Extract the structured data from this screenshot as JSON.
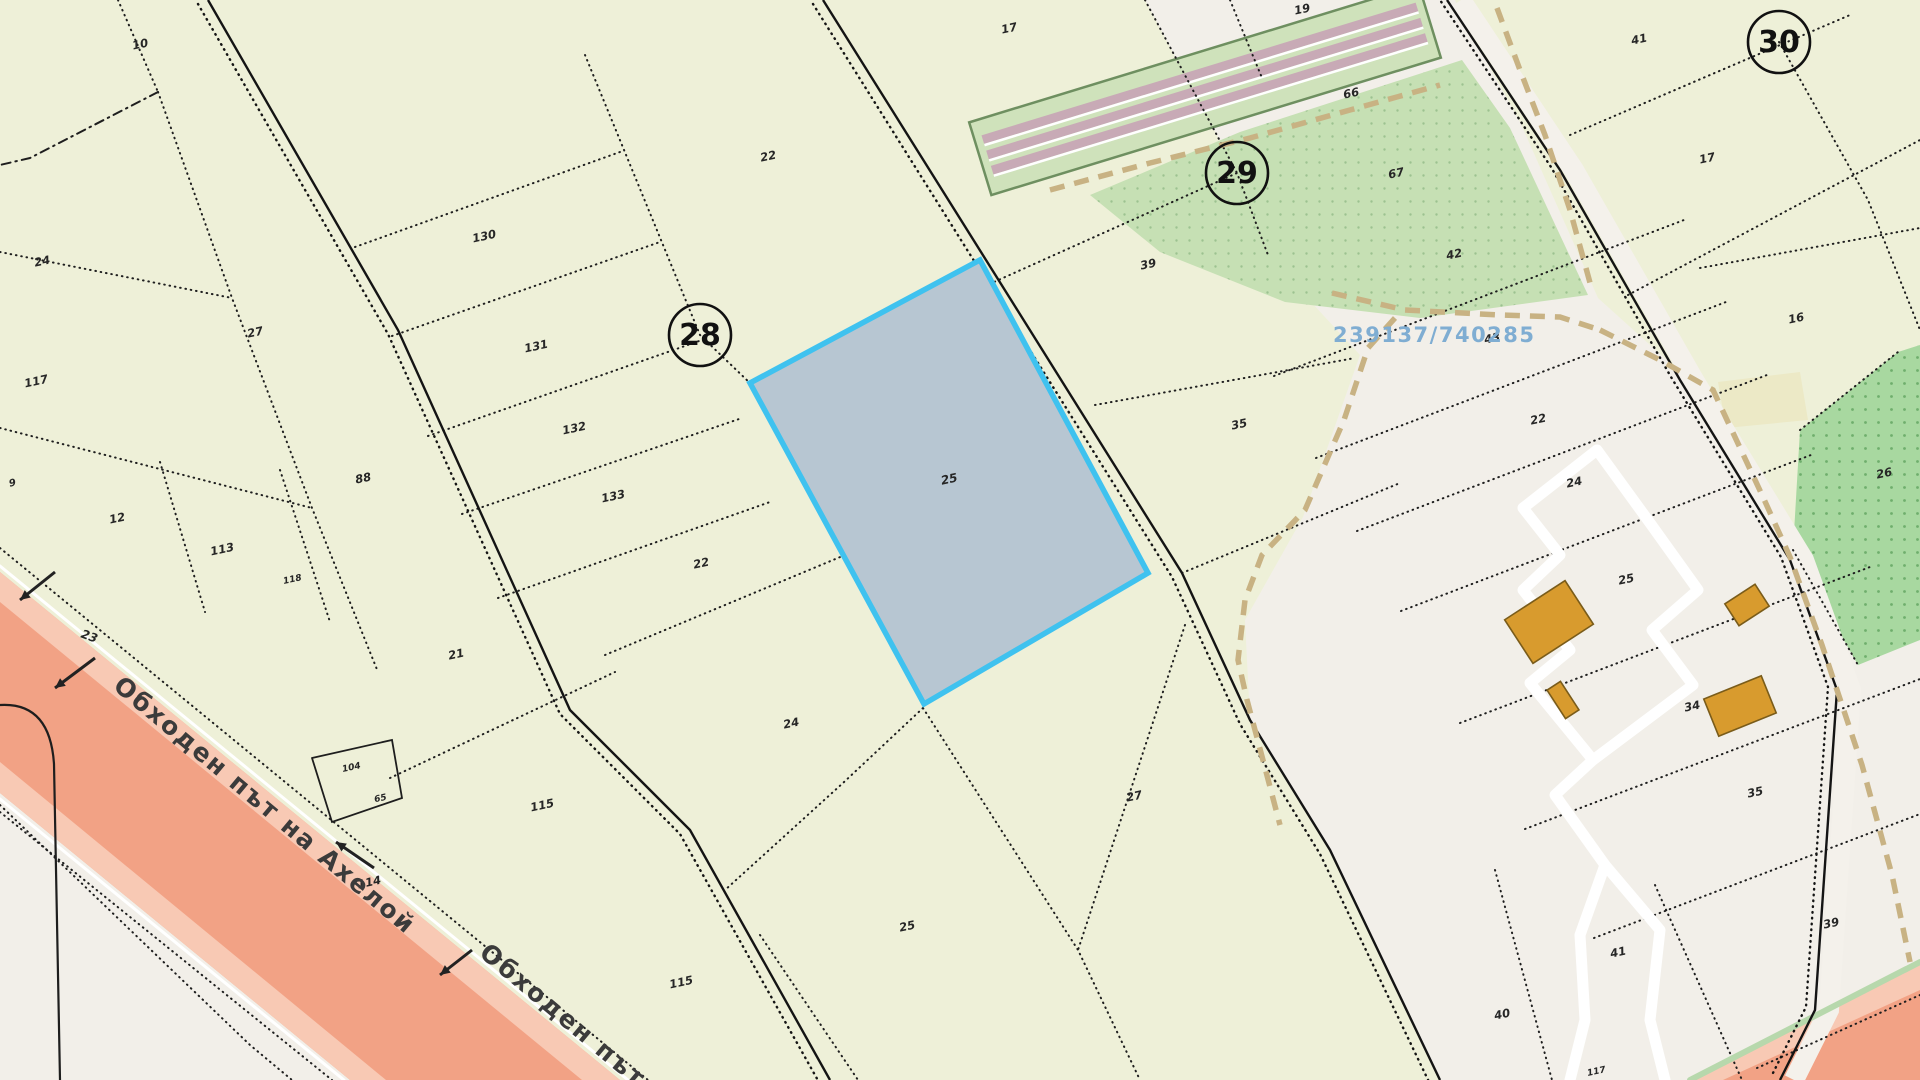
{
  "meta": {
    "type": "cadastral-map",
    "selected_parcel_label": "25",
    "reference_number": "239137/740285",
    "road_name": "Обходен път на Ахелой",
    "road_name_short": "Обходен път на",
    "block_numbers": [
      "28",
      "29",
      "30"
    ]
  },
  "colors": {
    "base": "#eef0d8",
    "urban_white": "#f2efe9",
    "road_salmon": "#f2a285",
    "road_salmon_edge": "#f8c9b4",
    "selected_fill": "#b7c6d2",
    "selected_border": "#3fc2ef",
    "boundary_dark": "#1e1e1e",
    "dash_tan": "#c8b283",
    "building_fill": "#d89b2e",
    "building_stroke": "#7a5c1a",
    "green_bright": "#a8d8a0",
    "green_light": "#c6e0b4",
    "rail_band": "#cfe2bb",
    "rail_stripe": "#c8aab6",
    "rail_edge": "#6e8f60",
    "ref_blue": "#7fadd2",
    "road_label_gray": "#3b3b3b"
  },
  "map": {
    "width": 1920,
    "height": 1080,
    "patterns": [
      {
        "id": "dotsA",
        "size": 13,
        "bg": "#a8d8a0",
        "dot": "#6fae6c",
        "r": 1.4
      },
      {
        "id": "dotsB",
        "size": 13,
        "bg": "#c6e0b4",
        "dot": "#9cc290",
        "r": 1.2
      }
    ],
    "polygons": [
      {
        "name": "urban-white-region",
        "pts": "1145,0 1237,173 1300,290 1360,355 1303,517 1245,620 1250,720 1330,850 1440,1080 1920,1080 1920,0",
        "fill": "#f2efe9"
      },
      {
        "name": "white-corner-bottom-left",
        "pts": "0,793 350,1080 0,1080",
        "fill": "#f2efe9"
      },
      {
        "name": "yellow-region-top-right",
        "pts": "1455,0 1920,0 1920,430 1858,452 1790,545 1700,390 1598,298 1520,122 1468,28",
        "fill": "#eef0d8"
      },
      {
        "name": "yellow-patch-small",
        "pts": "1718,382 1800,372 1808,420 1726,428",
        "fill": "#ece9c6"
      },
      {
        "name": "green-parcel-26",
        "pts": "1800,430 1898,352 1920,345 1920,640 1858,665 1793,550",
        "pattern": "dotsA"
      },
      {
        "name": "green-parcel-67",
        "pts": "1090,195 1240,132 1462,60 1510,128 1588,295 1420,318 1285,302 1160,252",
        "pattern": "dotsB"
      },
      {
        "name": "salmon-road-band-core",
        "pts": "0,572 620,1080 350,1080 0,793",
        "fill": "#f2a285"
      },
      {
        "name": "salmon-road-edge-upper",
        "pts": "0,572 620,1080 582,1080 0,602",
        "fill": "#f8c9b4"
      },
      {
        "name": "salmon-road-edge-lower",
        "pts": "0,762 386,1080 350,1080 0,793",
        "fill": "#f8c9b4"
      },
      {
        "name": "salmon-patch-bottom-right",
        "pts": "1690,1080 1920,962 1920,1080",
        "fill": "#f2a285"
      },
      {
        "name": "salmon-patch-edge",
        "pts": "1690,1080 1920,962 1920,990 1723,1080",
        "fill": "#f8c9b4"
      }
    ],
    "railway": {
      "cx": 1205,
      "cy": 90,
      "len": 470,
      "w": 76,
      "rot": -17,
      "stripes": [
        -22,
        -6,
        10
      ],
      "stripe_h": 9
    },
    "white_band_roadB": {
      "pts": "1447,0 1560,170 1680,380 1790,560 1837,690 1815,1010 1780,1080",
      "dx": 14,
      "dy": 0,
      "w": 20
    },
    "lines": [
      {
        "name": "boundary",
        "pts": "118,0 158,92"
      },
      {
        "name": "boundary",
        "pts": "158,92 30,158 0,165",
        "dash": "9 5 1.5 5"
      },
      {
        "name": "boundary",
        "pts": "158,92 232,298 312,508 378,672"
      },
      {
        "name": "boundary",
        "pts": "0,252 232,298"
      },
      {
        "name": "boundary",
        "pts": "0,428 312,508"
      },
      {
        "name": "boundary",
        "pts": "160,462 205,612"
      },
      {
        "name": "boundary",
        "pts": "280,470 330,622"
      },
      {
        "name": "boundary",
        "pts": "355,247 620,152"
      },
      {
        "name": "boundary",
        "pts": "392,336 660,242"
      },
      {
        "name": "boundary",
        "pts": "428,436 702,340"
      },
      {
        "name": "boundary",
        "pts": "462,514 742,418"
      },
      {
        "name": "boundary",
        "pts": "498,598 770,502"
      },
      {
        "name": "boundary",
        "pts": "585,55 700,335 752,385"
      },
      {
        "name": "boundary",
        "pts": "390,778 615,672"
      },
      {
        "name": "boundary",
        "pts": "605,655 845,555"
      },
      {
        "name": "boundary",
        "pts": "923,708 843,783 725,890"
      },
      {
        "name": "boundary",
        "pts": "923,708 1078,950 1140,1080"
      },
      {
        "name": "boundary",
        "pts": "1185,625 1078,950"
      },
      {
        "name": "boundary",
        "pts": "760,935 858,1080"
      },
      {
        "name": "boundary",
        "pts": "1145,0 1237,173"
      },
      {
        "name": "boundary",
        "pts": "965,295 1237,173 1268,255"
      },
      {
        "name": "boundary",
        "pts": "1095,405 1355,358"
      },
      {
        "name": "boundary",
        "pts": "1182,573 1400,483"
      },
      {
        "name": "boundary",
        "pts": "1274,376 1684,220"
      },
      {
        "name": "boundary",
        "pts": "1316,458 1726,302"
      },
      {
        "name": "boundary",
        "pts": "1357,531 1767,375"
      },
      {
        "name": "boundary",
        "pts": "1401,611 1811,455"
      },
      {
        "name": "boundary",
        "pts": "1460,723 1870,567"
      },
      {
        "name": "boundary",
        "pts": "1525,829 1920,679"
      },
      {
        "name": "boundary",
        "pts": "1594,938 1920,814"
      },
      {
        "name": "boundary",
        "pts": "1495,870 1552,1080"
      },
      {
        "name": "boundary",
        "pts": "1655,885 1742,1080"
      },
      {
        "name": "boundary",
        "pts": "1570,135 1850,15"
      },
      {
        "name": "boundary",
        "pts": "1779,42 1868,200 1920,330"
      },
      {
        "name": "boundary",
        "pts": "1628,295 1920,140"
      },
      {
        "name": "boundary",
        "pts": "1700,268 1920,228"
      },
      {
        "name": "boundary",
        "pts": "1800,430 1898,352"
      },
      {
        "name": "boundary",
        "pts": "1793,550 1858,665"
      },
      {
        "name": "boundary",
        "pts": "1757,1068 1920,995"
      },
      {
        "name": "boundary",
        "pts": "1230,0 1262,78"
      },
      {
        "name": "boundary",
        "pts": "0,548 648,1080"
      },
      {
        "name": "boundary",
        "pts": "0,812 332,1080"
      },
      {
        "name": "road-white-edge",
        "pts": "0,566 628,1080",
        "solid": true,
        "color": "#ffffff",
        "w": 3
      },
      {
        "name": "road-white-edge",
        "pts": "0,799 344,1080",
        "solid": true,
        "color": "#ffffff",
        "w": 3
      },
      {
        "name": "green-sliver",
        "pts": "1690,1080 1920,962",
        "solid": true,
        "color": "#b7d8ac",
        "w": 6
      },
      {
        "name": "parcel-outline-solid",
        "pts": "312,758 392,740 402,798 332,822 312,758",
        "solid": true,
        "w": 1.8
      },
      {
        "name": "rounded-corner-road",
        "path": "M0,705 Q50,702 54,764 L60,1080",
        "solid": true,
        "w": 2.2
      },
      {
        "name": "boundary",
        "pts": "0,805 250,1045 292,1080"
      }
    ],
    "roads_double": [
      {
        "name": "field-road-left",
        "pts": "208,0 398,330 570,710 690,830 830,1080",
        "dx": -10,
        "dy": 4
      },
      {
        "name": "field-road-center",
        "pts": "823,0 986,260 1182,573 1250,720 1330,850 1440,1080",
        "dx": -10,
        "dy": 4
      },
      {
        "name": "main-road-right",
        "pts": "1447,0 1560,170 1680,380 1790,560 1837,690 1815,1010 1780,1080",
        "dx": -9,
        "dy": -3
      }
    ],
    "tan_dashes": [
      {
        "pts": "1332,293 1405,310 1500,315 1560,317 1600,330"
      },
      {
        "pts": "1600,330 1660,360 1713,390 1763,497 1790,557 1822,645 1862,765 1892,875 1910,962"
      },
      {
        "pts": "1395,318 1368,348 1344,420 1305,510 1262,555 1245,600 1238,660 1247,700 1264,764 1280,825"
      },
      {
        "pts": "1497,8 1520,70 1545,135 1570,210 1592,290"
      },
      {
        "pts": "1050,190 1150,163 1250,138 1350,110 1440,85"
      }
    ],
    "streets": [
      {
        "name": "street-loop",
        "pts": "1597,450 1523,508 1560,555 1523,590 1570,650 1530,683 1593,760 1693,685 1652,630 1698,590 1650,523 1597,450"
      },
      {
        "name": "street",
        "pts": "1593,760 1555,795 1605,865 1580,935 1585,1020 1570,1080"
      },
      {
        "name": "street",
        "pts": "1605,865 1660,930 1650,1020 1665,1080"
      }
    ],
    "buildings": [
      {
        "x": 1549,
        "y": 622,
        "w": 72,
        "h": 52,
        "r": -33
      },
      {
        "x": 1747,
        "y": 605,
        "w": 36,
        "h": 26,
        "r": -33
      },
      {
        "x": 1740,
        "y": 706,
        "w": 62,
        "h": 40,
        "r": -22
      },
      {
        "x": 1563,
        "y": 700,
        "w": 16,
        "h": 34,
        "r": -33
      }
    ],
    "selected_parcel": {
      "pts": "980,260 1148,573 924,704 750,383",
      "label": "25",
      "lx": 950,
      "ly": 483
    },
    "circles": [
      {
        "n": "28",
        "x": 700,
        "y": 335,
        "r": 31
      },
      {
        "n": "29",
        "x": 1237,
        "y": 173,
        "r": 31
      },
      {
        "n": "30",
        "x": 1779,
        "y": 42,
        "r": 31
      }
    ],
    "labels": [
      {
        "t": "10",
        "x": 141,
        "y": 48
      },
      {
        "t": "24",
        "x": 43,
        "y": 265
      },
      {
        "t": "27",
        "x": 256,
        "y": 336
      },
      {
        "t": "130",
        "x": 485,
        "y": 240
      },
      {
        "t": "131",
        "x": 537,
        "y": 350
      },
      {
        "t": "132",
        "x": 575,
        "y": 432
      },
      {
        "t": "133",
        "x": 614,
        "y": 500
      },
      {
        "t": "88",
        "x": 364,
        "y": 482
      },
      {
        "t": "117",
        "x": 37,
        "y": 385
      },
      {
        "t": "9",
        "x": 13,
        "y": 486,
        "s": 10
      },
      {
        "t": "12",
        "x": 118,
        "y": 522
      },
      {
        "t": "113",
        "x": 223,
        "y": 553
      },
      {
        "t": "118",
        "x": 293,
        "y": 582,
        "s": 9
      },
      {
        "t": "21",
        "x": 457,
        "y": 658
      },
      {
        "t": "22",
        "x": 702,
        "y": 567
      },
      {
        "t": "23",
        "x": 88,
        "y": 640,
        "rot": 20,
        "s": 12
      },
      {
        "t": "104",
        "x": 352,
        "y": 770,
        "s": 9
      },
      {
        "t": "65",
        "x": 381,
        "y": 801,
        "s": 9
      },
      {
        "t": "114",
        "x": 370,
        "y": 886
      },
      {
        "t": "115",
        "x": 543,
        "y": 809
      },
      {
        "t": "115",
        "x": 682,
        "y": 986
      },
      {
        "t": "24",
        "x": 792,
        "y": 727
      },
      {
        "t": "25",
        "x": 908,
        "y": 930
      },
      {
        "t": "27",
        "x": 1135,
        "y": 800
      },
      {
        "t": "22",
        "x": 769,
        "y": 160
      },
      {
        "t": "17",
        "x": 1010,
        "y": 32
      },
      {
        "t": "39",
        "x": 1149,
        "y": 268
      },
      {
        "t": "35",
        "x": 1240,
        "y": 428
      },
      {
        "t": "19",
        "x": 1303,
        "y": 13
      },
      {
        "t": "66",
        "x": 1352,
        "y": 97
      },
      {
        "t": "67",
        "x": 1397,
        "y": 177
      },
      {
        "t": "42",
        "x": 1455,
        "y": 258
      },
      {
        "t": "43",
        "x": 1493,
        "y": 342
      },
      {
        "t": "22",
        "x": 1539,
        "y": 423
      },
      {
        "t": "24",
        "x": 1575,
        "y": 486
      },
      {
        "t": "25",
        "x": 1627,
        "y": 583
      },
      {
        "t": "34",
        "x": 1693,
        "y": 710
      },
      {
        "t": "35",
        "x": 1756,
        "y": 796
      },
      {
        "t": "39",
        "x": 1832,
        "y": 927
      },
      {
        "t": "41",
        "x": 1619,
        "y": 956
      },
      {
        "t": "40",
        "x": 1503,
        "y": 1018
      },
      {
        "t": "117",
        "x": 1597,
        "y": 1074,
        "s": 9
      },
      {
        "t": "41",
        "x": 1640,
        "y": 43
      },
      {
        "t": "17",
        "x": 1708,
        "y": 162
      },
      {
        "t": "16",
        "x": 1797,
        "y": 322
      },
      {
        "t": "26",
        "x": 1885,
        "y": 477
      }
    ],
    "ref_text": {
      "t": "239137/740285",
      "x": 1333,
      "y": 342,
      "s": 21
    },
    "road_labels": [
      {
        "t": "Обходен път на Ахелой",
        "x": 112,
        "y": 688,
        "rot": 40,
        "s": 25
      },
      {
        "t": "Обходен път на",
        "x": 478,
        "y": 955,
        "rot": 40,
        "s": 25
      }
    ],
    "arrows": [
      {
        "x1": 55,
        "y1": 572,
        "x2": 20,
        "y2": 600
      },
      {
        "x1": 95,
        "y1": 658,
        "x2": 55,
        "y2": 688
      },
      {
        "x1": 374,
        "y1": 868,
        "x2": 336,
        "y2": 842
      },
      {
        "x1": 472,
        "y1": 950,
        "x2": 440,
        "y2": 975
      }
    ]
  }
}
